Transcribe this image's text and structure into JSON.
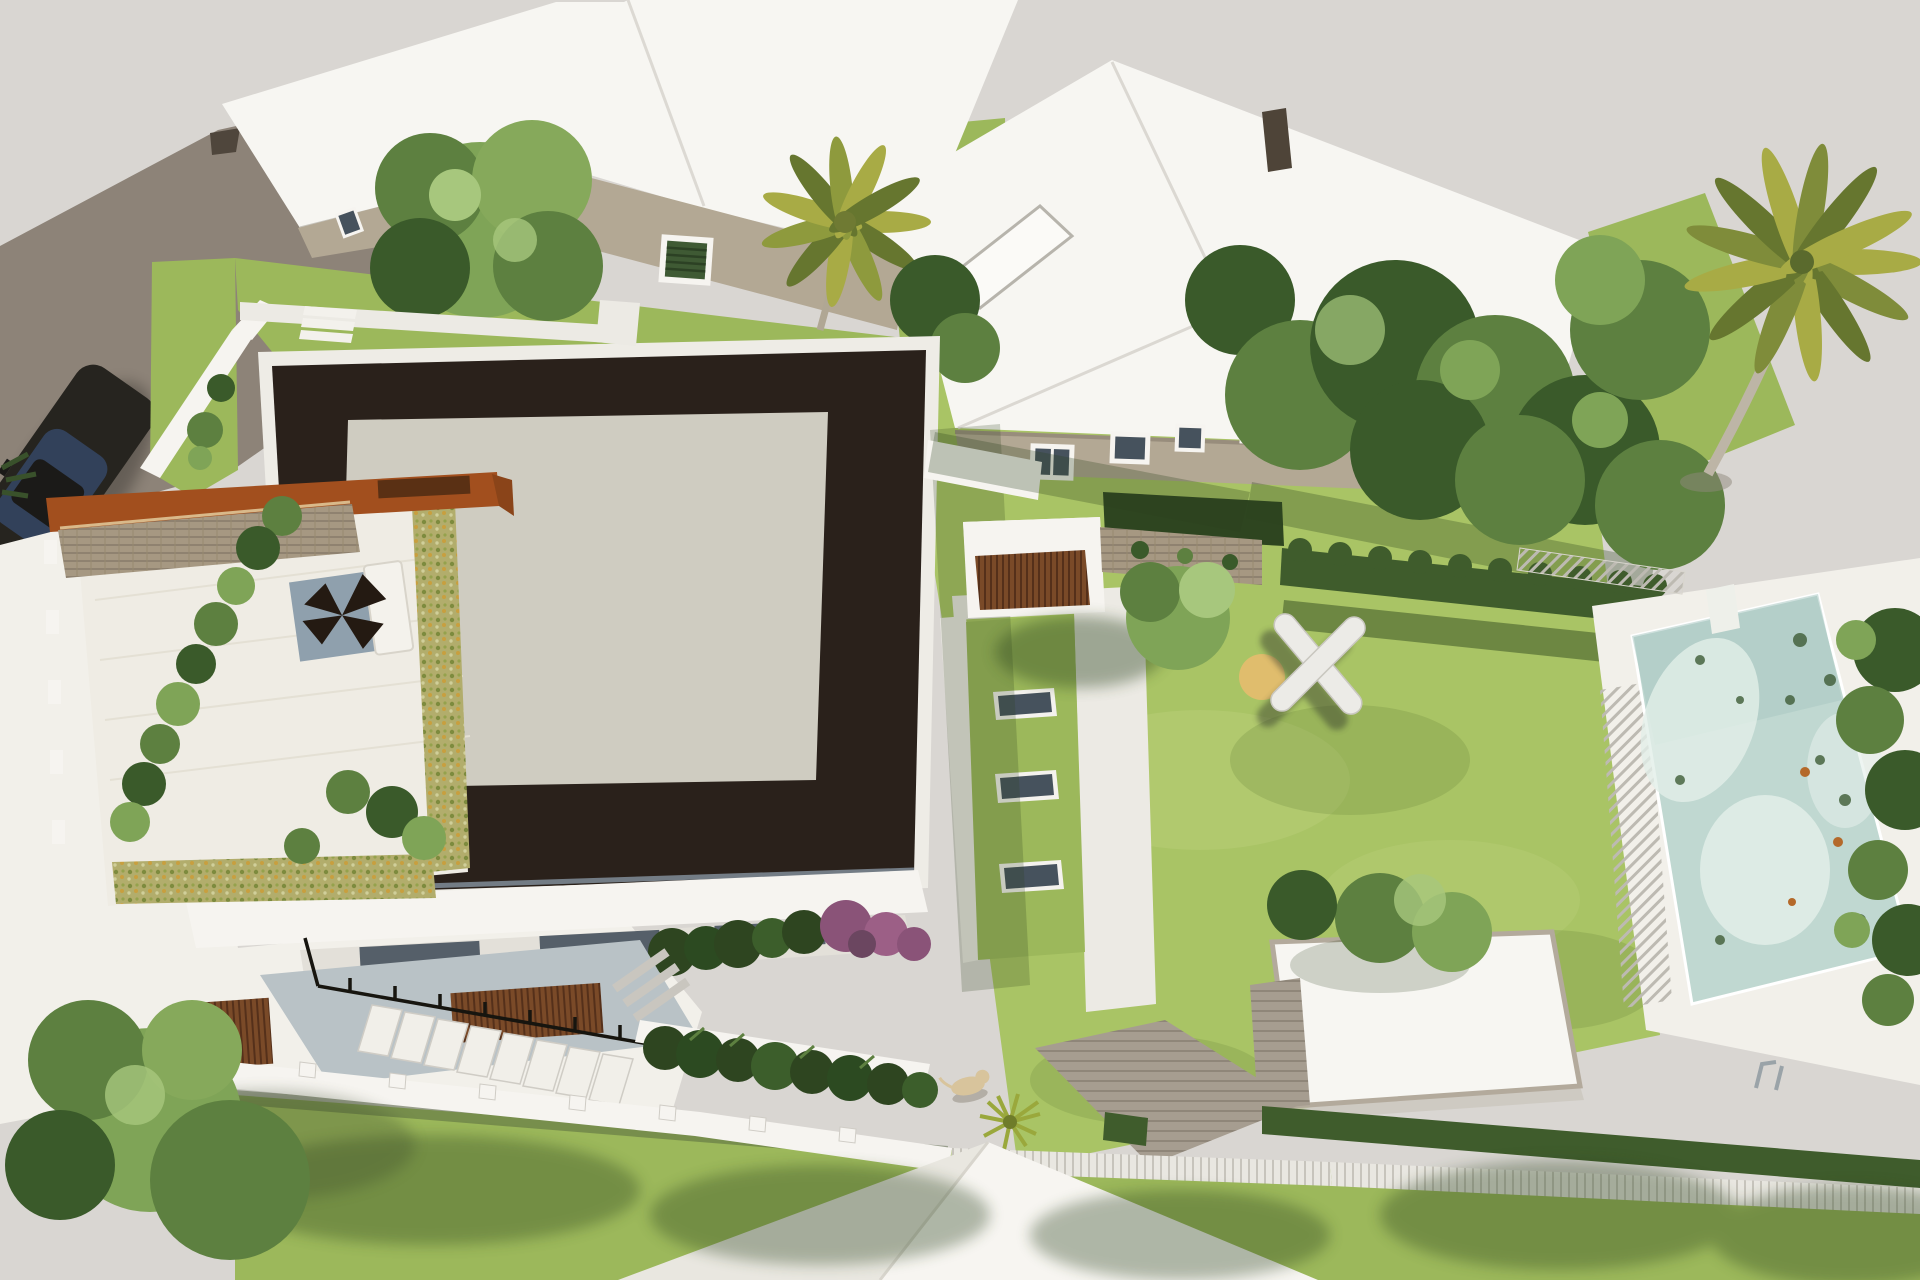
{
  "scene": {
    "type": "aerial-3d-architectural-render",
    "subject": "modern villa site plan with dark flat roof, roof terrace, lawn garden, swimming pool, neighboring houses, street with parked car"
  },
  "colors": {
    "background": "#d9d6d2",
    "road": "#8d8378",
    "road_dark": "#4f463c",
    "car_body": "#26241f",
    "car_glass": "#32415a",
    "white_surface": "#f2f0ea",
    "white_wall": "#f6f4f0",
    "white_shade": "#e3e0d9",
    "roof_white": "#f7f6f2",
    "wall_beige": "#b3a894",
    "roof_dark": "#2a211b",
    "roof_inner": "#cfccc1",
    "parapet": "#eeece6",
    "corten": "#a24f1e",
    "corten_dark": "#5a3014",
    "stone": "#a69882",
    "deck": "#efece4",
    "succulent": "#b2ad6c",
    "grass": "#9cb85b",
    "grass_light": "#a9c465",
    "grass_dark": "#6f913f",
    "hedge": "#3f5c2c",
    "hedge_dark": "#2e4520",
    "tree": "#5d8040",
    "tree_light": "#7fa457",
    "tree_dark": "#3a5a2a",
    "tree_highlight": "#a7c77d",
    "palm": "#a8ab45",
    "palm_dark": "#66762f",
    "trunk": "#b7afa0",
    "pool": "#c0d8d1",
    "pool_light": "#e2efe9",
    "pool_shade": "#a9c9c2",
    "path": "#eceae4",
    "paver": "#a69d90",
    "wood_slat": "#7a4a28",
    "glass": "#46525d",
    "sand": "#e5bd6e",
    "concrete_blue": "#b9c2c6",
    "shadow": "#2c421d",
    "purple_flower": "#8a5378",
    "dog": "#d8c49c",
    "fence": "#e9e7e1",
    "railing": "#17150f"
  }
}
